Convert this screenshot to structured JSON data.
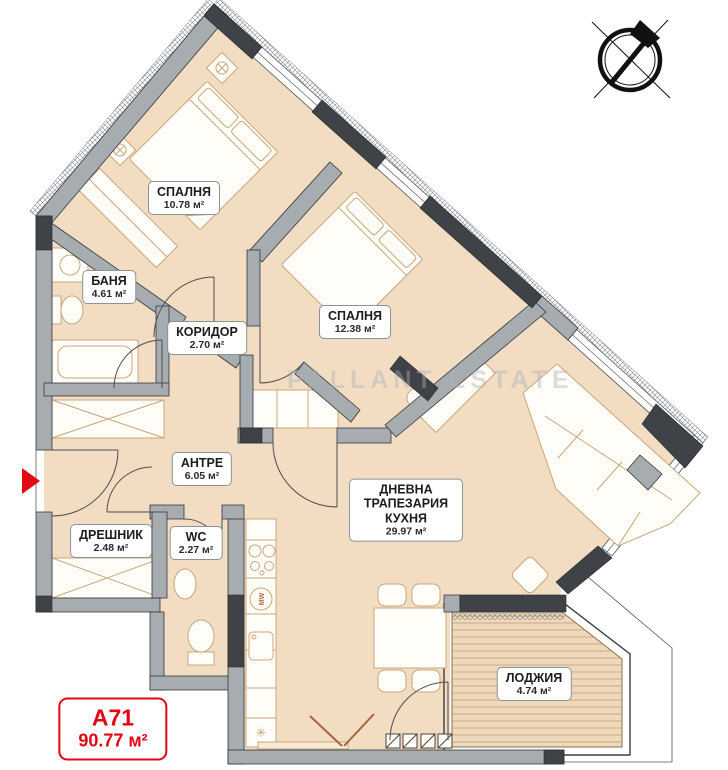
{
  "unit": {
    "code": "A71",
    "total_area": "90.77 м²"
  },
  "watermark": "PALLANT ESTATE",
  "rooms": [
    {
      "id": "bedroom-1",
      "name": "СПАЛНЯ",
      "area": "10.78 м²"
    },
    {
      "id": "bathroom",
      "name": "БАНЯ",
      "area": "4.61 м²"
    },
    {
      "id": "corridor",
      "name": "КОРИДОР",
      "area": "2.70 м²"
    },
    {
      "id": "bedroom-2",
      "name": "СПАЛНЯ",
      "area": "12.38 м²"
    },
    {
      "id": "entry-hall",
      "name": "АНТРЕ",
      "area": "6.05 м²"
    },
    {
      "id": "closet",
      "name": "ДРЕШНИК",
      "area": "2.48 м²"
    },
    {
      "id": "wc",
      "name": "WC",
      "area": "2.27 м²"
    },
    {
      "id": "living-dining-kitchen",
      "name": "ДНЕВНА ТРАПЕЗАРИЯ КУХНЯ",
      "area": "29.97 м²"
    },
    {
      "id": "loggia",
      "name": "ЛОДЖИЯ",
      "area": "4.74 м²"
    }
  ],
  "kitchen": {
    "appliance_label": "MW",
    "hob_symbol": "✳"
  },
  "icons": {
    "compass": "compass-north-icon",
    "entrance_arrow": "entrance-arrow-icon"
  },
  "colors": {
    "floor": "#f2dcc2",
    "deck": "#eed9bb",
    "wall_gray": "#a7acb0",
    "column_dark": "#3f4347",
    "accent_red": "#e30613",
    "furniture_outline": "#c9a67b"
  }
}
